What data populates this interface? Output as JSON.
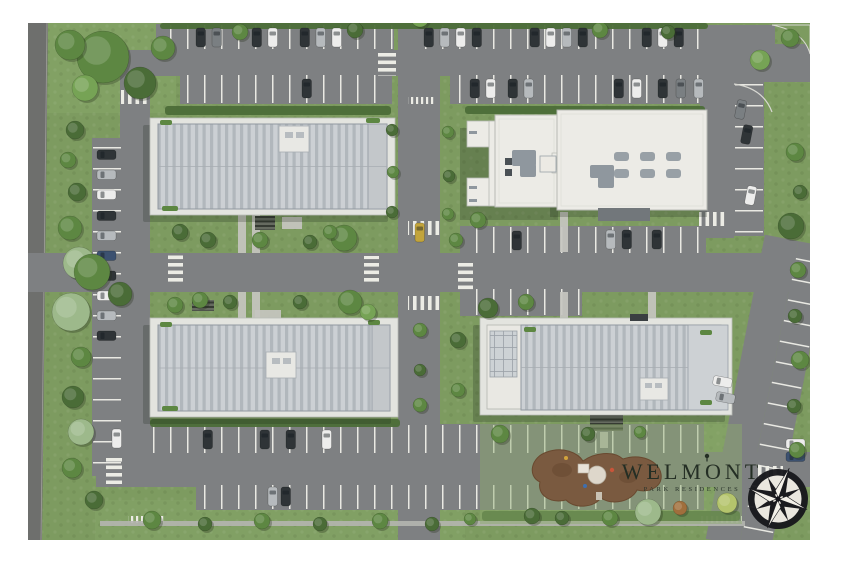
{
  "scene": {
    "type": "aerial-site-plan-render",
    "description": "Top-down architectural master plan render: four apartment buildings, internal roads with crosswalks, parking lots with cars, landscaping and a playground park"
  },
  "logo": {
    "title": "WELMONT",
    "subtitle": "PARK RESIDENCES",
    "color": "#242e24"
  },
  "buildings": [
    {
      "id": "building-1",
      "position": "top-left",
      "roof": "ribbed-gray"
    },
    {
      "id": "building-2",
      "position": "top-right",
      "roof": "flat-white"
    },
    {
      "id": "building-3",
      "position": "bottom-left",
      "roof": "ribbed-gray"
    },
    {
      "id": "building-4",
      "position": "bottom-right",
      "roof": "ribbed-gray"
    }
  ],
  "park": {
    "feature": "playground",
    "surface_color": "#7a5a40"
  },
  "compass": {
    "style": "8-point-rose",
    "dark": "#1b1b1f",
    "light": "#f4f1e9"
  },
  "palette": {
    "grass": "#7d9b60",
    "grass_light": "#8cab6d",
    "hedge": "#4c6d38",
    "road": "#7e8082",
    "road_dark": "#6e6f6d",
    "stall_line": "#e9e9e3",
    "sidewalk": "#c6c6c0",
    "deck": "#e3e4df",
    "roof_panel": "#ccd0d4",
    "roof_rib": "#b1b7bc",
    "roof_edge": "#9199a0",
    "white_roof": "#ecebe6",
    "unit_gray": "#8f979e",
    "park_brown": "#7a5a40",
    "car_colors": {
      "d": "#2f3437",
      "w": "#ededec",
      "s": "#b6babd",
      "b": "#3c5170",
      "g": "#7a7f82",
      "y": "#c2a43c"
    },
    "tree_colors": {
      "t1": "#4a6c37",
      "t2": "#5d8742",
      "t3": "#76a355",
      "t4": "#9db98b",
      "t5": "#a06f3c",
      "t6": "#b4c46c"
    }
  },
  "parking_lots": [
    {
      "x": 156,
      "y": 24,
      "w": 238,
      "h": 26,
      "p": "V"
    },
    {
      "x": 416,
      "y": 24,
      "w": 290,
      "h": 26,
      "p": "V"
    },
    {
      "x": 180,
      "y": 74,
      "w": 212,
      "h": 30,
      "p": "V"
    },
    {
      "x": 450,
      "y": 74,
      "w": 256,
      "h": 30,
      "p": "V"
    },
    {
      "x": 460,
      "y": 226,
      "w": 246,
      "h": 28,
      "p": "V"
    },
    {
      "x": 460,
      "y": 288,
      "w": 122,
      "h": 28,
      "p": "V"
    },
    {
      "x": 140,
      "y": 424,
      "w": 564,
      "h": 30,
      "p": "V"
    },
    {
      "x": 196,
      "y": 484,
      "w": 508,
      "h": 26,
      "p": "V"
    },
    {
      "x": 92,
      "y": 138,
      "w": 30,
      "h": 338,
      "p": "H"
    }
  ],
  "crosswalks": [
    {
      "x": 378,
      "y": 50,
      "w": 18,
      "h": 26,
      "t": "H"
    },
    {
      "x": 121,
      "y": 90,
      "w": 28,
      "h": 14,
      "t": "V"
    },
    {
      "x": 408,
      "y": 221,
      "w": 32,
      "h": 14,
      "t": "V"
    },
    {
      "x": 408,
      "y": 296,
      "w": 32,
      "h": 14,
      "t": "V"
    },
    {
      "x": 364,
      "y": 256,
      "w": 15,
      "h": 28,
      "t": "H"
    },
    {
      "x": 458,
      "y": 262,
      "w": 15,
      "h": 28,
      "t": "H"
    },
    {
      "x": 168,
      "y": 255,
      "w": 15,
      "h": 30,
      "t": "H"
    },
    {
      "x": 106,
      "y": 456,
      "w": 16,
      "h": 28,
      "t": "H"
    },
    {
      "x": 757,
      "y": 466,
      "w": 26,
      "h": 13,
      "t": "V"
    },
    {
      "x": 699,
      "y": 212,
      "w": 28,
      "h": 14,
      "t": "V"
    }
  ],
  "path_exits": [
    {
      "x": 30,
      "y": 10,
      "w": 26,
      "h": 7
    },
    {
      "x": 408,
      "y": 97,
      "w": 26,
      "h": 7
    },
    {
      "x": 128,
      "y": 516,
      "w": 38,
      "h": 7
    },
    {
      "x": 700,
      "y": 516,
      "w": 42,
      "h": 7
    }
  ],
  "walkways": [
    {
      "x": 238,
      "y": 215,
      "w": 8,
      "h": 38
    },
    {
      "x": 252,
      "y": 215,
      "w": 8,
      "h": 38
    },
    {
      "x": 238,
      "y": 292,
      "w": 8,
      "h": 26
    },
    {
      "x": 252,
      "y": 292,
      "w": 8,
      "h": 26
    },
    {
      "x": 560,
      "y": 212,
      "w": 8,
      "h": 40
    },
    {
      "x": 560,
      "y": 292,
      "w": 8,
      "h": 26
    },
    {
      "x": 648,
      "y": 292,
      "w": 8,
      "h": 26
    },
    {
      "x": 600,
      "y": 432,
      "w": 8,
      "h": 16
    },
    {
      "x": 282,
      "y": 217,
      "w": 20,
      "h": 12
    },
    {
      "x": 255,
      "y": 310,
      "w": 26,
      "h": 11
    }
  ],
  "hedges": [
    {
      "x": 160,
      "y": 23,
      "w": 548,
      "h": 6
    },
    {
      "x": 165,
      "y": 106,
      "w": 226,
      "h": 9
    },
    {
      "x": 465,
      "y": 106,
      "w": 240,
      "h": 8
    },
    {
      "x": 150,
      "y": 419,
      "w": 250,
      "h": 8
    },
    {
      "x": 482,
      "y": 511,
      "w": 258,
      "h": 10
    }
  ],
  "cars": [
    {
      "x": 196,
      "y": 28,
      "o": "v",
      "c": "d"
    },
    {
      "x": 212,
      "y": 28,
      "o": "v",
      "c": "g"
    },
    {
      "x": 252,
      "y": 28,
      "o": "v",
      "c": "d"
    },
    {
      "x": 268,
      "y": 28,
      "o": "v",
      "c": "w"
    },
    {
      "x": 300,
      "y": 28,
      "o": "v",
      "c": "d"
    },
    {
      "x": 316,
      "y": 28,
      "o": "v",
      "c": "s"
    },
    {
      "x": 332,
      "y": 28,
      "o": "v",
      "c": "w"
    },
    {
      "x": 424,
      "y": 28,
      "o": "v",
      "c": "d"
    },
    {
      "x": 440,
      "y": 28,
      "o": "v",
      "c": "s"
    },
    {
      "x": 456,
      "y": 28,
      "o": "v",
      "c": "w"
    },
    {
      "x": 472,
      "y": 28,
      "o": "v",
      "c": "d"
    },
    {
      "x": 530,
      "y": 28,
      "o": "v",
      "c": "d"
    },
    {
      "x": 546,
      "y": 28,
      "o": "v",
      "c": "w"
    },
    {
      "x": 562,
      "y": 28,
      "o": "v",
      "c": "s"
    },
    {
      "x": 578,
      "y": 28,
      "o": "v",
      "c": "d"
    },
    {
      "x": 642,
      "y": 28,
      "o": "v",
      "c": "d"
    },
    {
      "x": 658,
      "y": 28,
      "o": "v",
      "c": "w"
    },
    {
      "x": 674,
      "y": 28,
      "o": "v",
      "c": "d"
    },
    {
      "x": 302,
      "y": 79,
      "o": "v",
      "c": "d"
    },
    {
      "x": 470,
      "y": 79,
      "o": "v",
      "c": "d"
    },
    {
      "x": 486,
      "y": 79,
      "o": "v",
      "c": "w"
    },
    {
      "x": 508,
      "y": 79,
      "o": "v",
      "c": "d"
    },
    {
      "x": 524,
      "y": 79,
      "o": "v",
      "c": "s"
    },
    {
      "x": 614,
      "y": 79,
      "o": "v",
      "c": "d"
    },
    {
      "x": 632,
      "y": 79,
      "o": "v",
      "c": "w"
    },
    {
      "x": 658,
      "y": 79,
      "o": "v",
      "c": "d"
    },
    {
      "x": 676,
      "y": 79,
      "o": "v",
      "c": "g"
    },
    {
      "x": 694,
      "y": 79,
      "o": "v",
      "c": "s"
    },
    {
      "x": 512,
      "y": 231,
      "o": "v",
      "c": "d"
    },
    {
      "x": 606,
      "y": 230,
      "o": "v",
      "c": "s"
    },
    {
      "x": 622,
      "y": 230,
      "o": "v",
      "c": "d"
    },
    {
      "x": 652,
      "y": 230,
      "o": "v",
      "c": "d"
    },
    {
      "x": 415,
      "y": 223,
      "o": "v",
      "c": "y"
    },
    {
      "x": 97,
      "y": 150,
      "o": "h",
      "c": "d"
    },
    {
      "x": 97,
      "y": 170,
      "o": "h",
      "c": "s"
    },
    {
      "x": 97,
      "y": 190,
      "o": "h",
      "c": "w"
    },
    {
      "x": 97,
      "y": 211,
      "o": "h",
      "c": "d"
    },
    {
      "x": 97,
      "y": 231,
      "o": "h",
      "c": "s"
    },
    {
      "x": 97,
      "y": 251,
      "o": "h",
      "c": "b"
    },
    {
      "x": 97,
      "y": 271,
      "o": "h",
      "c": "d"
    },
    {
      "x": 97,
      "y": 291,
      "o": "h",
      "c": "w"
    },
    {
      "x": 97,
      "y": 311,
      "o": "h",
      "c": "s"
    },
    {
      "x": 97,
      "y": 331,
      "o": "h",
      "c": "d"
    },
    {
      "x": 203,
      "y": 430,
      "o": "v",
      "c": "d"
    },
    {
      "x": 260,
      "y": 430,
      "o": "v",
      "c": "d"
    },
    {
      "x": 286,
      "y": 430,
      "o": "v",
      "c": "d"
    },
    {
      "x": 322,
      "y": 430,
      "o": "v",
      "c": "w"
    },
    {
      "x": 112,
      "y": 429,
      "o": "v",
      "c": "w"
    },
    {
      "x": 268,
      "y": 487,
      "o": "v",
      "c": "s"
    },
    {
      "x": 281,
      "y": 487,
      "o": "v",
      "c": "d"
    },
    {
      "x": 736,
      "y": 100,
      "o": "v",
      "c": "g",
      "a": 11
    },
    {
      "x": 742,
      "y": 125,
      "o": "v",
      "c": "d",
      "a": 11
    },
    {
      "x": 746,
      "y": 186,
      "o": "v",
      "c": "w",
      "a": 11
    },
    {
      "x": 713,
      "y": 377,
      "o": "h",
      "c": "w",
      "a": 11
    },
    {
      "x": 716,
      "y": 393,
      "o": "h",
      "c": "s",
      "a": 11
    },
    {
      "x": 786,
      "y": 439,
      "o": "h",
      "c": "w"
    },
    {
      "x": 786,
      "y": 452,
      "o": "h",
      "c": "b"
    }
  ],
  "trees": [
    {
      "x": 103,
      "y": 57,
      "r": 26,
      "c": "t2"
    },
    {
      "x": 140,
      "y": 83,
      "r": 16,
      "c": "t1"
    },
    {
      "x": 85,
      "y": 88,
      "r": 13,
      "c": "t3"
    },
    {
      "x": 70,
      "y": 45,
      "r": 15,
      "c": "t2"
    },
    {
      "x": 163,
      "y": 48,
      "r": 12,
      "c": "t2"
    },
    {
      "x": 75,
      "y": 130,
      "r": 9,
      "c": "t1"
    },
    {
      "x": 68,
      "y": 160,
      "r": 8,
      "c": "t2"
    },
    {
      "x": 77,
      "y": 192,
      "r": 9,
      "c": "t1"
    },
    {
      "x": 70,
      "y": 228,
      "r": 12,
      "c": "t2"
    },
    {
      "x": 79,
      "y": 263,
      "r": 16,
      "c": "t4"
    },
    {
      "x": 71,
      "y": 312,
      "r": 19,
      "c": "t4"
    },
    {
      "x": 81,
      "y": 357,
      "r": 10,
      "c": "t2"
    },
    {
      "x": 73,
      "y": 397,
      "r": 11,
      "c": "t1"
    },
    {
      "x": 81,
      "y": 432,
      "r": 13,
      "c": "t4"
    },
    {
      "x": 72,
      "y": 468,
      "r": 10,
      "c": "t2"
    },
    {
      "x": 94,
      "y": 500,
      "r": 9,
      "c": "t1"
    },
    {
      "x": 240,
      "y": 32,
      "r": 8,
      "c": "t2"
    },
    {
      "x": 355,
      "y": 30,
      "r": 8,
      "c": "t1"
    },
    {
      "x": 600,
      "y": 30,
      "r": 8,
      "c": "t2"
    },
    {
      "x": 668,
      "y": 32,
      "r": 7,
      "c": "t1"
    },
    {
      "x": 420,
      "y": 18,
      "r": 9,
      "c": "t3"
    },
    {
      "x": 392,
      "y": 130,
      "r": 6,
      "c": "t1"
    },
    {
      "x": 393,
      "y": 172,
      "r": 6,
      "c": "t2"
    },
    {
      "x": 392,
      "y": 212,
      "r": 6,
      "c": "t1"
    },
    {
      "x": 448,
      "y": 132,
      "r": 6,
      "c": "t2"
    },
    {
      "x": 449,
      "y": 176,
      "r": 6,
      "c": "t1"
    },
    {
      "x": 448,
      "y": 214,
      "r": 6,
      "c": "t2"
    },
    {
      "x": 456,
      "y": 240,
      "r": 7,
      "c": "t2"
    },
    {
      "x": 344,
      "y": 238,
      "r": 13,
      "c": "t2"
    },
    {
      "x": 350,
      "y": 302,
      "r": 12,
      "c": "t2"
    },
    {
      "x": 368,
      "y": 312,
      "r": 8,
      "c": "t3"
    },
    {
      "x": 478,
      "y": 220,
      "r": 8,
      "c": "t2"
    },
    {
      "x": 488,
      "y": 308,
      "r": 10,
      "c": "t1"
    },
    {
      "x": 526,
      "y": 302,
      "r": 8,
      "c": "t2"
    },
    {
      "x": 92,
      "y": 272,
      "r": 18,
      "c": "t2"
    },
    {
      "x": 120,
      "y": 294,
      "r": 12,
      "c": "t1"
    },
    {
      "x": 208,
      "y": 240,
      "r": 8,
      "c": "t1"
    },
    {
      "x": 260,
      "y": 240,
      "r": 8,
      "c": "t2"
    },
    {
      "x": 310,
      "y": 242,
      "r": 7,
      "c": "t1"
    },
    {
      "x": 200,
      "y": 300,
      "r": 8,
      "c": "t2"
    },
    {
      "x": 300,
      "y": 302,
      "r": 7,
      "c": "t1"
    },
    {
      "x": 795,
      "y": 152,
      "r": 9,
      "c": "t2"
    },
    {
      "x": 800,
      "y": 192,
      "r": 7,
      "c": "t1"
    },
    {
      "x": 791,
      "y": 226,
      "r": 13,
      "c": "t1"
    },
    {
      "x": 798,
      "y": 270,
      "r": 8,
      "c": "t2"
    },
    {
      "x": 795,
      "y": 316,
      "r": 7,
      "c": "t1"
    },
    {
      "x": 800,
      "y": 360,
      "r": 9,
      "c": "t2"
    },
    {
      "x": 794,
      "y": 406,
      "r": 7,
      "c": "t1"
    },
    {
      "x": 797,
      "y": 450,
      "r": 8,
      "c": "t2"
    },
    {
      "x": 760,
      "y": 60,
      "r": 10,
      "c": "t3"
    },
    {
      "x": 790,
      "y": 38,
      "r": 9,
      "c": "t2"
    },
    {
      "x": 180,
      "y": 232,
      "r": 8,
      "c": "t1"
    },
    {
      "x": 330,
      "y": 232,
      "r": 7,
      "c": "t2"
    },
    {
      "x": 175,
      "y": 305,
      "r": 8,
      "c": "t2"
    },
    {
      "x": 230,
      "y": 302,
      "r": 7,
      "c": "t1"
    },
    {
      "x": 420,
      "y": 330,
      "r": 7,
      "c": "t2"
    },
    {
      "x": 420,
      "y": 370,
      "r": 6,
      "c": "t1"
    },
    {
      "x": 420,
      "y": 405,
      "r": 7,
      "c": "t2"
    },
    {
      "x": 458,
      "y": 340,
      "r": 8,
      "c": "t1"
    },
    {
      "x": 458,
      "y": 390,
      "r": 7,
      "c": "t2"
    },
    {
      "x": 500,
      "y": 434,
      "r": 9,
      "c": "t2"
    },
    {
      "x": 532,
      "y": 516,
      "r": 8,
      "c": "t1"
    },
    {
      "x": 648,
      "y": 512,
      "r": 13,
      "c": "t4"
    },
    {
      "x": 680,
      "y": 508,
      "r": 7,
      "c": "t5"
    },
    {
      "x": 727,
      "y": 503,
      "r": 10,
      "c": "t6"
    },
    {
      "x": 562,
      "y": 518,
      "r": 7,
      "c": "t1"
    },
    {
      "x": 610,
      "y": 518,
      "r": 8,
      "c": "t2"
    },
    {
      "x": 588,
      "y": 434,
      "r": 7,
      "c": "t1"
    },
    {
      "x": 640,
      "y": 432,
      "r": 6,
      "c": "t2"
    },
    {
      "x": 152,
      "y": 520,
      "r": 9,
      "c": "t2"
    },
    {
      "x": 205,
      "y": 524,
      "r": 7,
      "c": "t1"
    },
    {
      "x": 262,
      "y": 521,
      "r": 8,
      "c": "t2"
    },
    {
      "x": 320,
      "y": 524,
      "r": 7,
      "c": "t1"
    },
    {
      "x": 380,
      "y": 521,
      "r": 8,
      "c": "t2"
    },
    {
      "x": 432,
      "y": 524,
      "r": 7,
      "c": "t1"
    },
    {
      "x": 470,
      "y": 519,
      "r": 6,
      "c": "t2"
    }
  ]
}
